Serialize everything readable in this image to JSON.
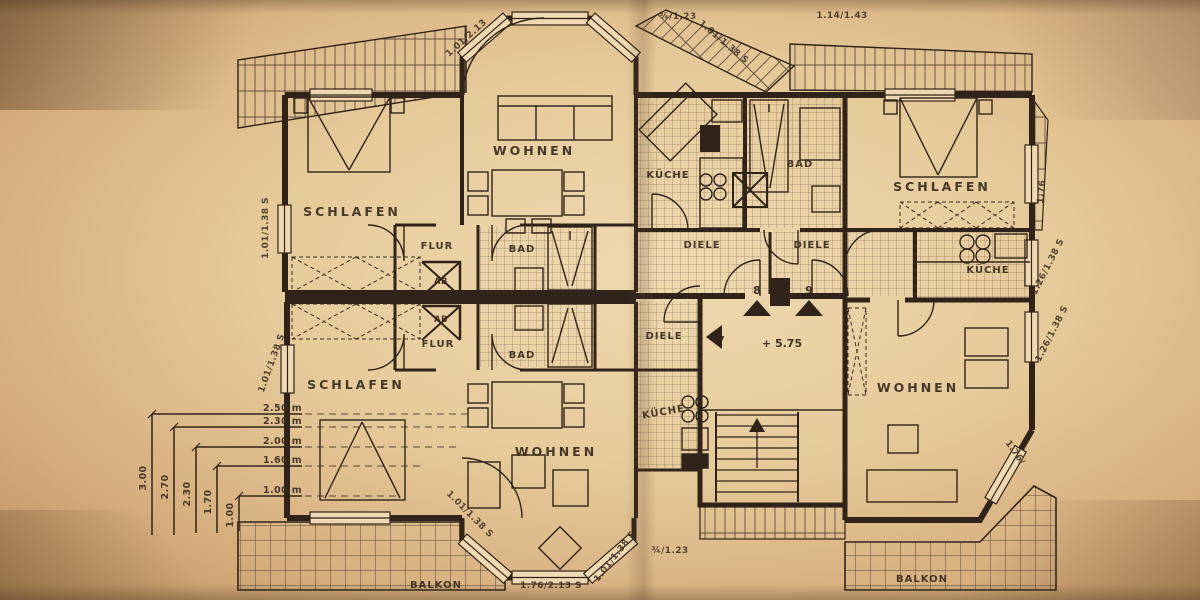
{
  "plan": {
    "rooms": {
      "schlafen_top_left": "SCHLAFEN",
      "wohnen_top": "WOHNEN",
      "flur_top": "FLUR",
      "ab_top": "AB",
      "bad_top_left": "BAD",
      "kueche_top_left": "KÜCHE",
      "diele_top_left": "DIELE",
      "diele_top_right": "DIELE",
      "bad_top_right": "BAD",
      "schlafen_top_right": "SCHLAFEN",
      "kueche_right": "KÜCHE",
      "wohnen_right": "WOHNEN",
      "schlafen_bottom_left": "SCHLAFEN",
      "flur_bottom": "FLUR",
      "ab_bottom": "AB",
      "bad_bottom_left": "BAD",
      "diele_bottom": "DIELE",
      "kueche_bottom": "KÜCHE",
      "wohnen_bottom": "WOHNEN",
      "balkon_left": "BALKON",
      "balkon_right": "BALKON"
    },
    "stairs": {
      "door_left": "7",
      "door_mid": "8",
      "door_right": "9",
      "level": "+ 5.75"
    },
    "dimensions": {
      "top_bay_left": "1.01/2.13",
      "top_bay_right": "1.01/1.38 S",
      "top_mid": "¾/1.23",
      "top_right": "1.14/1.43",
      "left_upper": "1.01/1.38 S",
      "left_lower": "1.01/1.38 S",
      "right_upper": "1.76",
      "right_mid_upper": "1.26/1.38 S",
      "right_mid_lower": "1.26/1.38 S",
      "right_lower": "1.76/",
      "bottom_bay_left": "1.01/1.38 S",
      "bottom_bay_right": "1.01/1.38 S",
      "bottom_mid": "1.76/2.13 S",
      "bottom_right_mid": "¾/1.23"
    },
    "height_scale": {
      "h1": "2.50 m",
      "h2": "2.30 m",
      "h3": "2.00 m",
      "h4": "1.60 m",
      "h5": "1.00 m",
      "v1": "3.00",
      "v2": "2.70",
      "v3": "2.30",
      "v4": "1.70",
      "v5": "1.00"
    },
    "colors": {
      "paper": "#e6cb9a",
      "ink": "#30241a"
    }
  }
}
